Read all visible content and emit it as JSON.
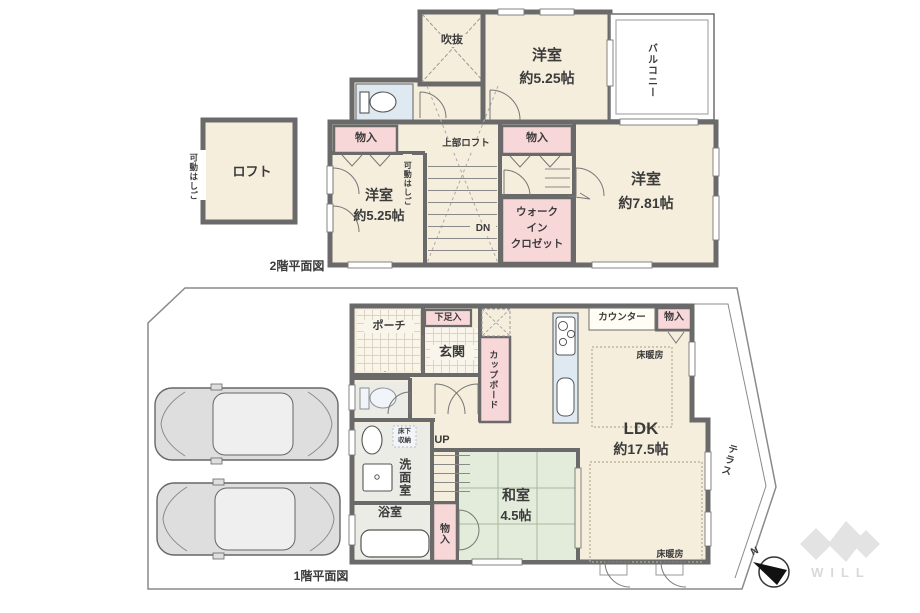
{
  "colors": {
    "wall": "#6a6a6a",
    "room_cream": "#f5eedd",
    "closet_pink": "#f8d7d9",
    "wet_blue": "#dfe9f2",
    "tatami_green": "#e3ecdb",
    "text": "#3b3b3b",
    "boundary_line": "#8a8a8a",
    "logo_gray": "#e3e3e3"
  },
  "floor2": {
    "caption": "2階平面図",
    "loft": {
      "label": "ロフト"
    },
    "loft_ladder": {
      "label": "可動はしご"
    },
    "void": {
      "label": "吹抜"
    },
    "room_top": {
      "name": "洋室",
      "size": "約5.25帖"
    },
    "balcony": {
      "label": "バルコニー"
    },
    "storage_left": {
      "label": "物入"
    },
    "upper_loft": {
      "label": "上部ロフト"
    },
    "stair_ladder": {
      "label": "可動はしご"
    },
    "storage_mid": {
      "label": "物入"
    },
    "stairs": {
      "label": "DN"
    },
    "room_left": {
      "name": "洋室",
      "size": "約5.25帖"
    },
    "room_right": {
      "name": "洋室",
      "size": "約7.81帖"
    },
    "wic": {
      "line1": "ウォーク",
      "line2": "イン",
      "line3": "クロゼット"
    }
  },
  "floor1": {
    "caption": "1階平面図",
    "porch": {
      "label": "ポーチ"
    },
    "shoe_storage": {
      "label": "下足入"
    },
    "entrance": {
      "label": "玄関"
    },
    "cupboard": {
      "label": "カップボード"
    },
    "counter": {
      "label": "カウンター"
    },
    "storage_top": {
      "label": "物入"
    },
    "floor_heating_top": {
      "label": "床暖房"
    },
    "floor_heating_bottom": {
      "label": "床暖房"
    },
    "ldk": {
      "name": "LDK",
      "size": "約17.5帖"
    },
    "terrace": {
      "label": "テラス"
    },
    "underfloor_storage": {
      "line1": "床下",
      "line2": "収納"
    },
    "stairs": {
      "label": "UP"
    },
    "washroom": {
      "label": "洗面室"
    },
    "bathroom": {
      "label": "浴室"
    },
    "storage_washitsu": {
      "label": "物入"
    },
    "washitsu": {
      "name": "和室",
      "size": "4.5帖"
    }
  },
  "compass": {
    "north": "N"
  },
  "brand": {
    "name": "WILL"
  }
}
